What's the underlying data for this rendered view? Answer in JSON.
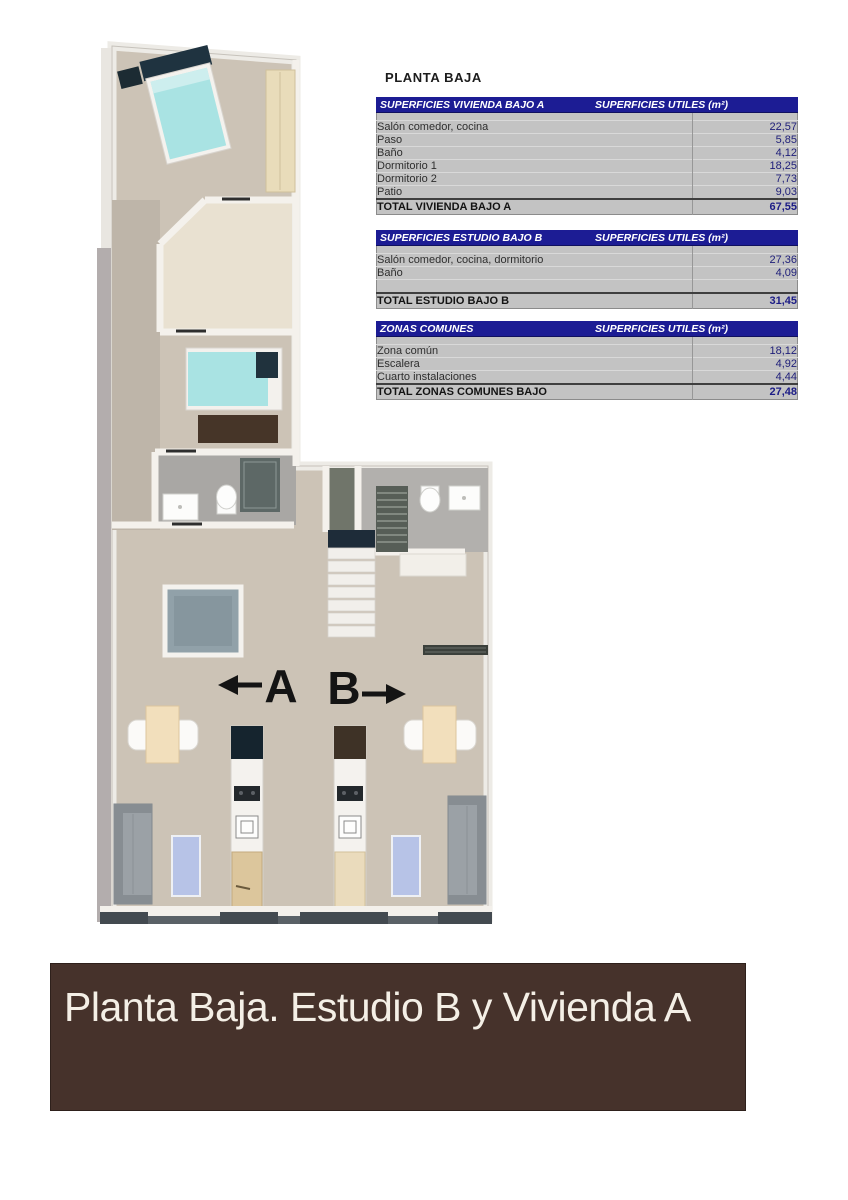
{
  "title": "PLANTA BAJA",
  "floorplan": {
    "unit_a_label": "A",
    "unit_b_label": "B"
  },
  "tables": [
    {
      "header_left": "SUPERFICIES VIVIENDA BAJO A",
      "header_right": "SUPERFICIES UTILES (m²)",
      "rows": [
        [
          "Salón comedor, cocina",
          "22,57"
        ],
        [
          "Paso",
          "5,85"
        ],
        [
          "Baño",
          "4,12"
        ],
        [
          "Dormitorio 1",
          "18,25"
        ],
        [
          "Dormitorio 2",
          "7,73"
        ],
        [
          "Patio",
          "9,03"
        ]
      ],
      "total": [
        "TOTAL VIVIENDA BAJO A",
        "67,55"
      ]
    },
    {
      "header_left": "SUPERFICIES ESTUDIO BAJO B",
      "header_right": "SUPERFICIES UTILES (m²)",
      "rows": [
        [
          "Salón comedor, cocina, dormitorio",
          "27,36"
        ],
        [
          "Baño",
          "4,09"
        ],
        [
          "",
          ""
        ]
      ],
      "total": [
        "TOTAL ESTUDIO BAJO B",
        "31,45"
      ]
    },
    {
      "header_left": "ZONAS COMUNES",
      "header_right": "SUPERFICIES UTILES (m²)",
      "rows": [
        [
          "Zona común",
          "18,12"
        ],
        [
          "Escalera",
          "4,92"
        ],
        [
          "Cuarto instalaciones",
          "4,44"
        ]
      ],
      "total": [
        "TOTAL ZONAS COMUNES BAJO",
        "27,48"
      ]
    }
  ],
  "banner": {
    "text": "Planta Baja. Estudio B y Vivienda A"
  },
  "colors": {
    "table_header_bg": "#1c1c94",
    "table_body_bg": "#c3c3c3",
    "value_text": "#20207a",
    "banner_bg": "#46322b",
    "floor_beige": "#ccc3b6",
    "patio_cream": "#e9e1d1",
    "bathroom_gray": "#a9a7a4",
    "bed_teal": "#a9e3e3"
  }
}
